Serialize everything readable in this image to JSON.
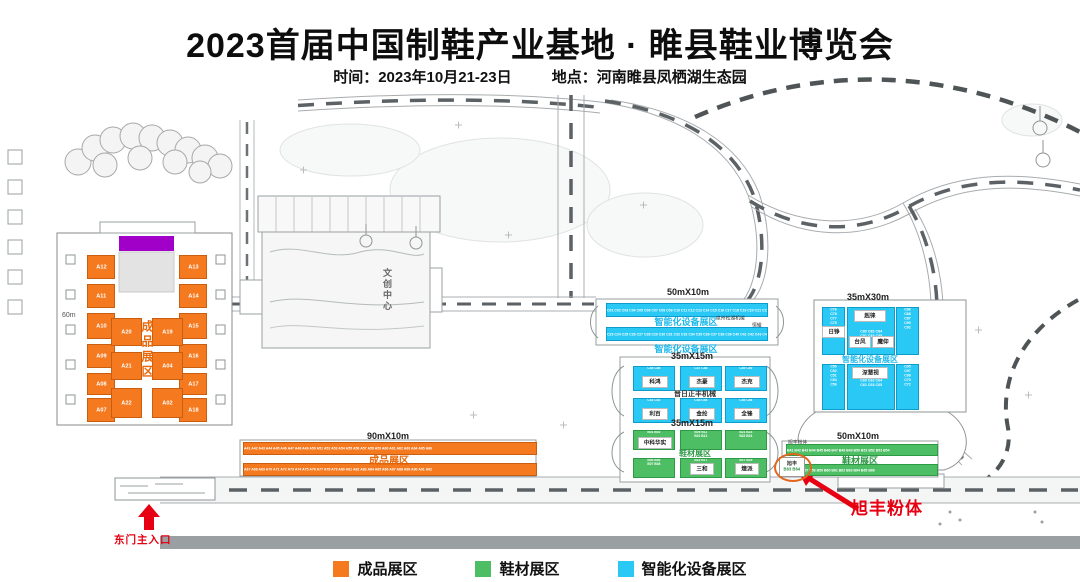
{
  "header": {
    "title": "2023首届中国制鞋产业基地 · 睢县鞋业博览会",
    "time_label": "时间：2023年10月21-23日",
    "place_label": "地点：河南睢县凤栖湖生态园"
  },
  "colors": {
    "orange": "#F4791F",
    "green": "#4DBE63",
    "cyan": "#29C8F5",
    "purple": "#A100C8",
    "red": "#E60012"
  },
  "hall": {
    "zone_label": "成品展区",
    "width_label": "60m",
    "left_col": [
      "A12",
      "A11",
      "A10",
      "A09",
      "A08",
      "A07"
    ],
    "right_col": [
      "A13",
      "A14",
      "A15",
      "A16",
      "A17",
      "A18"
    ],
    "mid_left_col": [
      "A20",
      "A21",
      "A22"
    ],
    "mid_right_col": [
      "A19",
      "A04",
      "A02"
    ]
  },
  "center_building": {
    "label": "文创中心"
  },
  "north_strips": {
    "size_label": "50mX10m",
    "zone_label": "智能化设备展区",
    "zone_label_below": "智能化设备展区",
    "row1_codes": "C01 C02 C03 C04 C05 C06 C07 C08 C09 C10 C11 C12 C13 C14 C15 C16 C17 C18 C19 C20 C21 C22",
    "row2_codes": "C23 C24 C25 C26 C27 C28 C29 C30 C31 C32 C33 C34 C35 C36 C37 C38 C39 C40 C41 C42 C43 C44",
    "side_label_1": "泉州松湖机械",
    "side_label_2": "恒耀"
  },
  "machine_block": {
    "size_label": "35mX15m",
    "center_label": "晋日正丰机械",
    "booths": [
      {
        "name": "科鸿",
        "codes": "C45 C46"
      },
      {
        "name": "杰豪",
        "codes": "C47 C48"
      },
      {
        "name": "杰克",
        "codes": "C49 C50"
      },
      {
        "name": "利百",
        "codes": "C51 C52"
      },
      {
        "name": "金纶",
        "codes": "C53 C54"
      },
      {
        "name": "全锋",
        "codes": "C55 C56"
      }
    ]
  },
  "material_block": {
    "size_label": "35mX15m",
    "zone_label": "鞋材展区",
    "booths": [
      {
        "name": "中科华实",
        "codes": "B01 B03"
      },
      {
        "name": "",
        "codes": "B09 B11\nB10 B12"
      },
      {
        "name": "",
        "codes": "B21 B23\nB22 B24"
      },
      {
        "name": "",
        "codes": "B05 B06\nB07 B08"
      },
      {
        "name": "三和",
        "codes": "B15 B17"
      },
      {
        "name": "煌派",
        "codes": "B27 B29"
      }
    ]
  },
  "east_block": {
    "size_label": "35mX30m",
    "zone_label": "智能化设备展区",
    "upper": {
      "left_codes": "C76\nC78\nC77\nC75\nC73",
      "box1": "赳徕",
      "box2": "日铮",
      "box3": "台风",
      "box4": "魔仰",
      "mid_codes": "C80 C82 C84\nC81 C83 C85",
      "right_codes": "C86\nC88\nC87\nC90\nC92"
    },
    "lower": {
      "left_codes": "C50\nC52\nC51\nC54\nC56",
      "box1": "深慧视",
      "mid_codes": "C60 C62 C64\nC61 C63 C65",
      "right_codes": "C95\nC97\nC98\nC70\nC72"
    }
  },
  "south_orange": {
    "size_label": "90mX10m",
    "zone_label": "成品展区",
    "row1_codes": "A41 A42 A43 A44 A45 A46 A47 A48 A49 A50 A51 A52 A53 A54 A55 A56 A57 A58 A59 A60 A61 A62 A63 A64 A65 A66",
    "row2_codes": "A67 A68 A69 A70 A71 A72 A73 A74 A75 A76 A77 A78 A79 A80 A81 A82 A83 A84 A85 A86 A87 A88 A89 A90 A91 A92"
  },
  "south_green": {
    "size_label": "50mX10m",
    "zone_label": "鞋材展区",
    "left_note": "旭丰粉体",
    "row1_codes": "B41 B42 B43 B44 B45 B46 B47 B48 B49 B50 B51 B52 B53 B54",
    "row2_codes": "B55 B56 B57 B58 B59 B60 B61 B62 B63 B64 B65 B66"
  },
  "callout": {
    "label": "旭丰粉体",
    "booth_name": "旭丰",
    "booth_codes": "B63 B64"
  },
  "entrance": {
    "label": "东门主入口"
  },
  "legend": {
    "items": [
      {
        "label": "成品展区",
        "style": "background:#F4791F"
      },
      {
        "label": "鞋材展区",
        "style": "background:#4DBE63"
      },
      {
        "label": "智能化设备展区",
        "style": "background:#29C8F5"
      }
    ]
  }
}
